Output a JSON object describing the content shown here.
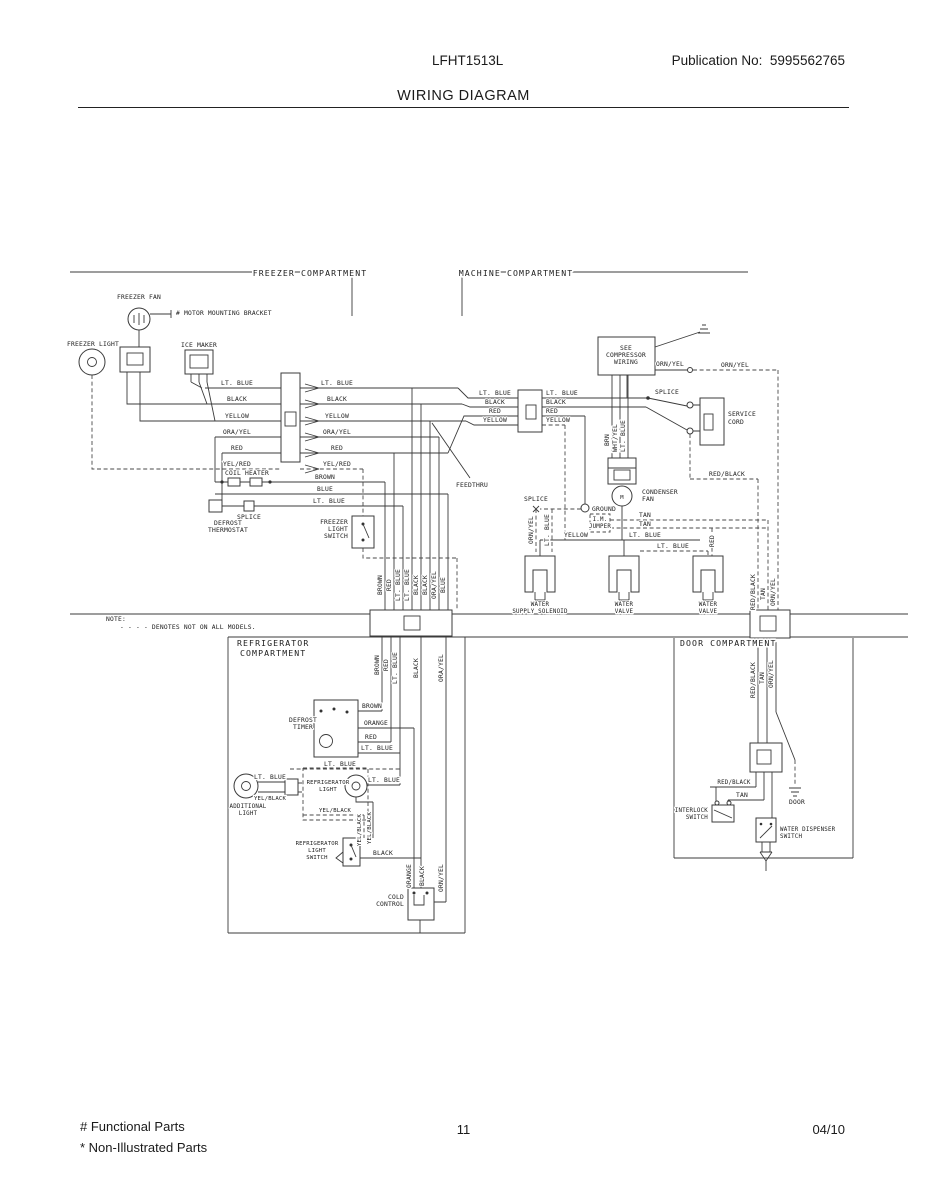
{
  "page": {
    "model": "LFHT1513L",
    "publication": "Publication No:  5995562765",
    "title": "WIRING DIAGRAM",
    "footer": {
      "functional": "# Functional Parts",
      "non_illustrated": "* Non-Illustrated Parts",
      "page_number": "11",
      "date": "04/10"
    }
  },
  "diagram": {
    "note_label": "NOTE:",
    "note_text": "- - - -  DENOTES NOT ON ALL MODELS.",
    "labels": [
      {
        "t": "FREEZER COMPARTMENT",
        "x": 310,
        "y": 276,
        "big": 1
      },
      {
        "t": "MACHINE COMPARTMENT",
        "x": 516,
        "y": 276,
        "big": 1
      },
      {
        "t": "REFRIGERATOR",
        "x": 237,
        "y": 646,
        "a": "s",
        "big": 1
      },
      {
        "t": "COMPARTMENT",
        "x": 240,
        "y": 656,
        "a": "s",
        "big": 1
      },
      {
        "t": "DOOR COMPARTMENT",
        "x": 680,
        "y": 646,
        "a": "s",
        "big": 1
      },
      {
        "t": "FREEZER FAN",
        "x": 139,
        "y": 299
      },
      {
        "t": "# MOTOR MOUNTING BRACKET",
        "x": 176,
        "y": 315,
        "a": "s"
      },
      {
        "t": "FREEZER LIGHT",
        "x": 93,
        "y": 346
      },
      {
        "t": "ICE MAKER",
        "x": 199,
        "y": 347
      },
      {
        "t": "LT. BLUE",
        "x": 237,
        "y": 385
      },
      {
        "t": "BLACK",
        "x": 237,
        "y": 401
      },
      {
        "t": "YELLOW",
        "x": 237,
        "y": 418
      },
      {
        "t": "ORA/YEL",
        "x": 237,
        "y": 434
      },
      {
        "t": "RED",
        "x": 237,
        "y": 450
      },
      {
        "t": "YEL/RED",
        "x": 237,
        "y": 466
      },
      {
        "t": "LT. BLUE",
        "x": 337,
        "y": 385
      },
      {
        "t": "BLACK",
        "x": 337,
        "y": 401
      },
      {
        "t": "YELLOW",
        "x": 337,
        "y": 418
      },
      {
        "t": "ORA/YEL",
        "x": 337,
        "y": 434
      },
      {
        "t": "RED",
        "x": 337,
        "y": 450
      },
      {
        "t": "YEL/RED",
        "x": 337,
        "y": 466
      },
      {
        "t": "COIL HEATER",
        "x": 247,
        "y": 475
      },
      {
        "t": "BROWN",
        "x": 325,
        "y": 479
      },
      {
        "t": "BLUE",
        "x": 325,
        "y": 491
      },
      {
        "t": "LT. BLUE",
        "x": 329,
        "y": 503
      },
      {
        "t": "SPLICE",
        "x": 249,
        "y": 519
      },
      {
        "t": "DEFROST",
        "x": 228,
        "y": 525
      },
      {
        "t": "THERMOSTAT",
        "x": 228,
        "y": 532
      },
      {
        "t": "FREEZER",
        "x": 348,
        "y": 524,
        "a": "e"
      },
      {
        "t": "LIGHT",
        "x": 348,
        "y": 531,
        "a": "e"
      },
      {
        "t": "SWITCH",
        "x": 348,
        "y": 538,
        "a": "e"
      },
      {
        "t": "BROWN",
        "x": 382,
        "y": 585,
        "r": 1
      },
      {
        "t": "RED",
        "x": 391,
        "y": 585,
        "r": 1
      },
      {
        "t": "LT. BLUE",
        "x": 400,
        "y": 585,
        "r": 1
      },
      {
        "t": "LT. BLUE",
        "x": 409,
        "y": 585,
        "r": 1
      },
      {
        "t": "BLACK",
        "x": 418,
        "y": 585,
        "r": 1
      },
      {
        "t": "BLACK",
        "x": 427,
        "y": 585,
        "r": 1
      },
      {
        "t": "ORA/YEL",
        "x": 436,
        "y": 585,
        "r": 1
      },
      {
        "t": "BLUE",
        "x": 445,
        "y": 585,
        "r": 1
      },
      {
        "t": "NOTE:",
        "x": 106,
        "y": 621,
        "a": "s"
      },
      {
        "t": "- - - -  DENOTES NOT ON ALL MODELS.",
        "x": 120,
        "y": 629,
        "a": "s"
      },
      {
        "t": "FEEDTHRU",
        "x": 472,
        "y": 487
      },
      {
        "t": "SEE",
        "x": 626,
        "y": 350
      },
      {
        "t": "COMPRESSOR",
        "x": 626,
        "y": 357
      },
      {
        "t": "WIRING",
        "x": 626,
        "y": 364
      },
      {
        "t": "ORN/YEL",
        "x": 670,
        "y": 366
      },
      {
        "t": "ORN/YEL",
        "x": 735,
        "y": 367
      },
      {
        "t": "LT. BLUE",
        "x": 495,
        "y": 395
      },
      {
        "t": "BLACK",
        "x": 495,
        "y": 404
      },
      {
        "t": "RED",
        "x": 495,
        "y": 413
      },
      {
        "t": "YELLOW",
        "x": 495,
        "y": 422
      },
      {
        "t": "LT. BLUE",
        "x": 546,
        "y": 395,
        "a": "s"
      },
      {
        "t": "BLACK",
        "x": 546,
        "y": 404,
        "a": "s"
      },
      {
        "t": "RED",
        "x": 546,
        "y": 413,
        "a": "s"
      },
      {
        "t": "YELLOW",
        "x": 546,
        "y": 422,
        "a": "s"
      },
      {
        "t": "SPLICE",
        "x": 655,
        "y": 394,
        "a": "s"
      },
      {
        "t": "SERVICE",
        "x": 728,
        "y": 416,
        "a": "s"
      },
      {
        "t": "CORD",
        "x": 728,
        "y": 424,
        "a": "s"
      },
      {
        "t": "RED/BLACK",
        "x": 727,
        "y": 476
      },
      {
        "t": "BRN",
        "x": 609,
        "y": 440,
        "r": 1
      },
      {
        "t": "WHT/YEL",
        "x": 617,
        "y": 438,
        "r": 1
      },
      {
        "t": "LT. BLUE",
        "x": 625,
        "y": 436,
        "r": 1
      },
      {
        "t": "CONDENSER",
        "x": 642,
        "y": 494,
        "a": "s"
      },
      {
        "t": "FAN",
        "x": 642,
        "y": 501,
        "a": "s"
      },
      {
        "t": "M",
        "x": 622,
        "y": 499,
        "fs": 5.5
      },
      {
        "t": "GROUND",
        "x": 592,
        "y": 511,
        "a": "s"
      },
      {
        "t": "SPLICE",
        "x": 536,
        "y": 501
      },
      {
        "t": "ORN/YEL",
        "x": 533,
        "y": 530,
        "r": 1
      },
      {
        "t": "LT. BLUE",
        "x": 549,
        "y": 530,
        "r": 1
      },
      {
        "t": "TAN",
        "x": 645,
        "y": 517
      },
      {
        "t": "TAN",
        "x": 645,
        "y": 526
      },
      {
        "t": "I.M.",
        "x": 600,
        "y": 521,
        "fs": 5.8
      },
      {
        "t": "JUMPER",
        "x": 600,
        "y": 528,
        "fs": 5.8
      },
      {
        "t": "YELLOW",
        "x": 576,
        "y": 537
      },
      {
        "t": "LT. BLUE",
        "x": 645,
        "y": 537
      },
      {
        "t": "LT. BLUE",
        "x": 673,
        "y": 548
      },
      {
        "t": "RED",
        "x": 714,
        "y": 541,
        "r": 1
      },
      {
        "t": "WATER",
        "x": 540,
        "y": 606,
        "fs": 5.8
      },
      {
        "t": "SUPPLY SOLENOID",
        "x": 540,
        "y": 613,
        "fs": 5.8
      },
      {
        "t": "WATER",
        "x": 624,
        "y": 606,
        "fs": 5.8
      },
      {
        "t": "VALVE",
        "x": 624,
        "y": 613,
        "fs": 5.8
      },
      {
        "t": "WATER",
        "x": 708,
        "y": 606,
        "fs": 5.8
      },
      {
        "t": "VALVE",
        "x": 708,
        "y": 613,
        "fs": 5.8
      },
      {
        "t": "RED/BLACK",
        "x": 755,
        "y": 592,
        "r": 1
      },
      {
        "t": "TAN",
        "x": 765,
        "y": 594,
        "r": 1
      },
      {
        "t": "ORN/YEL",
        "x": 775,
        "y": 592,
        "r": 1
      },
      {
        "t": "BROWN",
        "x": 379,
        "y": 665,
        "r": 1
      },
      {
        "t": "RED",
        "x": 388,
        "y": 665,
        "r": 1
      },
      {
        "t": "LT. BLUE",
        "x": 397,
        "y": 668,
        "r": 1
      },
      {
        "t": "BLACK",
        "x": 418,
        "y": 668,
        "r": 1
      },
      {
        "t": "ORA/YEL",
        "x": 443,
        "y": 668,
        "r": 1
      },
      {
        "t": "BROWN",
        "x": 372,
        "y": 708
      },
      {
        "t": "ORANGE",
        "x": 376,
        "y": 725
      },
      {
        "t": "RED",
        "x": 371,
        "y": 739
      },
      {
        "t": "LT. BLUE",
        "x": 377,
        "y": 750
      },
      {
        "t": "DEFROST",
        "x": 303,
        "y": 722
      },
      {
        "t": "TIMER",
        "x": 303,
        "y": 729
      },
      {
        "t": "LT. BLUE",
        "x": 340,
        "y": 766
      },
      {
        "t": "REFRIGERATOR",
        "x": 328,
        "y": 784,
        "fs": 5.6
      },
      {
        "t": "LIGHT",
        "x": 328,
        "y": 791,
        "fs": 5.6
      },
      {
        "t": "LT. BLUE",
        "x": 270,
        "y": 779
      },
      {
        "t": "YEL/BLACK",
        "x": 270,
        "y": 800,
        "fs": 5.6
      },
      {
        "t": "ADDITIONAL",
        "x": 248,
        "y": 808,
        "fs": 5.8
      },
      {
        "t": "LIGHT",
        "x": 248,
        "y": 815,
        "fs": 5.8
      },
      {
        "t": "LT. BLUE",
        "x": 384,
        "y": 782
      },
      {
        "t": "YEL/BLACK",
        "x": 335,
        "y": 812,
        "fs": 5.6
      },
      {
        "t": "YEL/BLACK",
        "x": 361,
        "y": 830,
        "r": 1,
        "fs": 5.6
      },
      {
        "t": "YEL/BLACK",
        "x": 371,
        "y": 828,
        "r": 1,
        "fs": 5.6
      },
      {
        "t": "REFRIGERATOR",
        "x": 317,
        "y": 845,
        "fs": 5.6
      },
      {
        "t": "LIGHT",
        "x": 317,
        "y": 852,
        "fs": 5.6
      },
      {
        "t": "SWITCH",
        "x": 317,
        "y": 859,
        "fs": 5.6
      },
      {
        "t": "BLACK",
        "x": 383,
        "y": 855
      },
      {
        "t": "ORANGE",
        "x": 411,
        "y": 876,
        "r": 1
      },
      {
        "t": "BLACK",
        "x": 424,
        "y": 876,
        "r": 1
      },
      {
        "t": "ORN/YEL",
        "x": 443,
        "y": 878,
        "r": 1
      },
      {
        "t": "COLD",
        "x": 404,
        "y": 899,
        "a": "e"
      },
      {
        "t": "CONTROL",
        "x": 404,
        "y": 906,
        "a": "e"
      },
      {
        "t": "RED/BLACK",
        "x": 755,
        "y": 680,
        "r": 1
      },
      {
        "t": "TAN",
        "x": 764,
        "y": 678,
        "r": 1
      },
      {
        "t": "ORN/YEL",
        "x": 773,
        "y": 674,
        "r": 1
      },
      {
        "t": "RED/BLACK",
        "x": 734,
        "y": 784,
        "fs": 5.8
      },
      {
        "t": "TAN",
        "x": 742,
        "y": 797
      },
      {
        "t": "INTERLOCK",
        "x": 708,
        "y": 812,
        "a": "e",
        "fs": 5.8
      },
      {
        "t": "SWITCH",
        "x": 708,
        "y": 819,
        "a": "e",
        "fs": 5.8
      },
      {
        "t": "DOOR",
        "x": 797,
        "y": 804
      },
      {
        "t": "WATER DISPENSER",
        "x": 780,
        "y": 831,
        "a": "s",
        "fs": 5.8
      },
      {
        "t": "SWITCH",
        "x": 780,
        "y": 838,
        "a": "s",
        "fs": 5.8
      }
    ]
  }
}
